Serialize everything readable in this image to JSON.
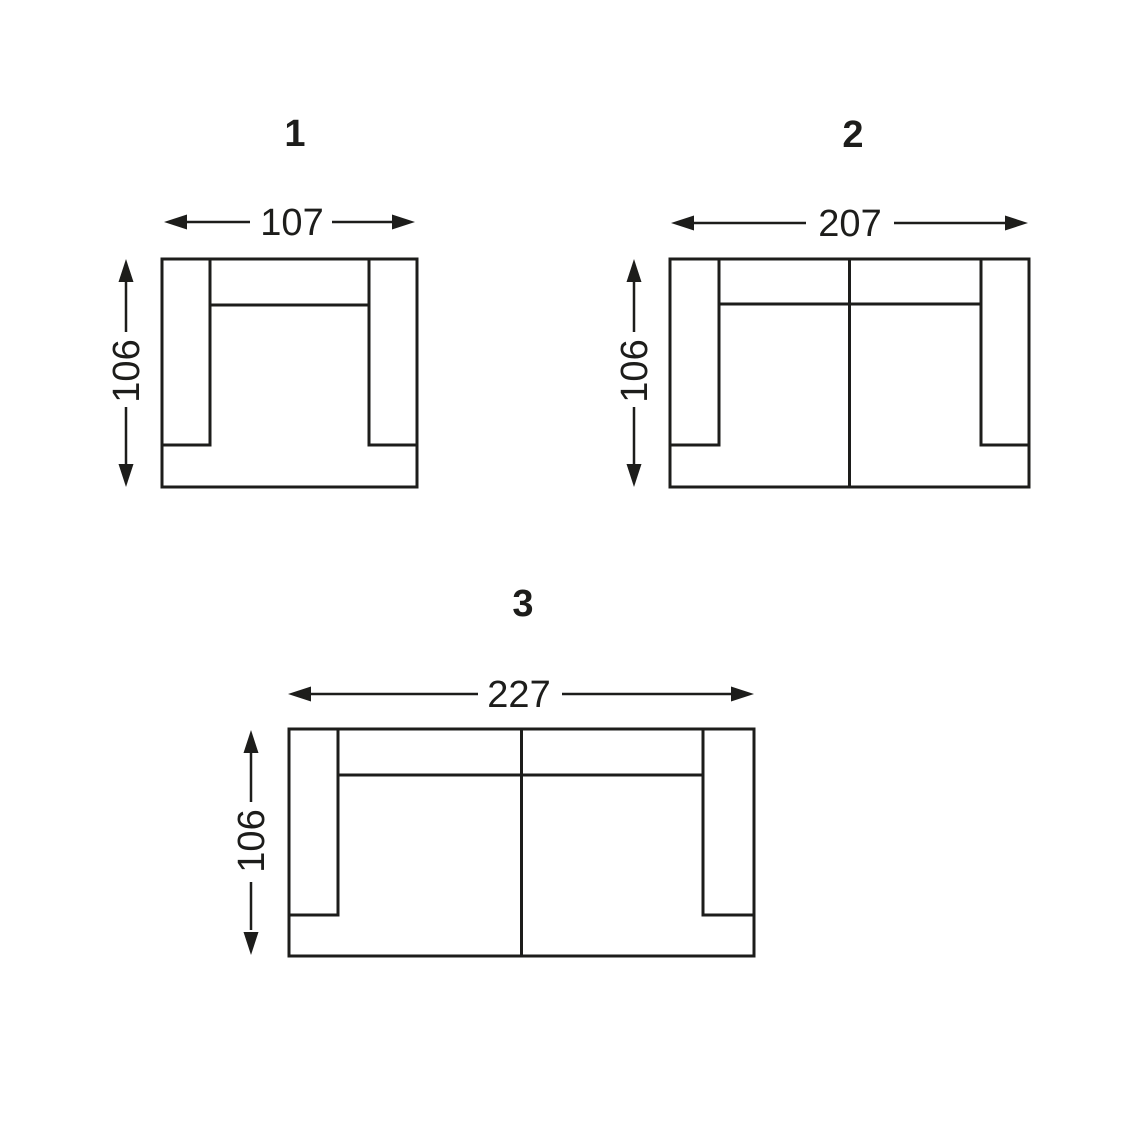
{
  "page": {
    "background": "#ffffff",
    "line_color": "#1d1d1b"
  },
  "diagrams": [
    {
      "label": "1",
      "width_label": "107",
      "depth_label": "106",
      "seat_sections": 1
    },
    {
      "label": "2",
      "width_label": "207",
      "depth_label": "106",
      "seat_sections": 2
    },
    {
      "label": "3",
      "width_label": "227",
      "depth_label": "106",
      "seat_sections": 2
    }
  ]
}
